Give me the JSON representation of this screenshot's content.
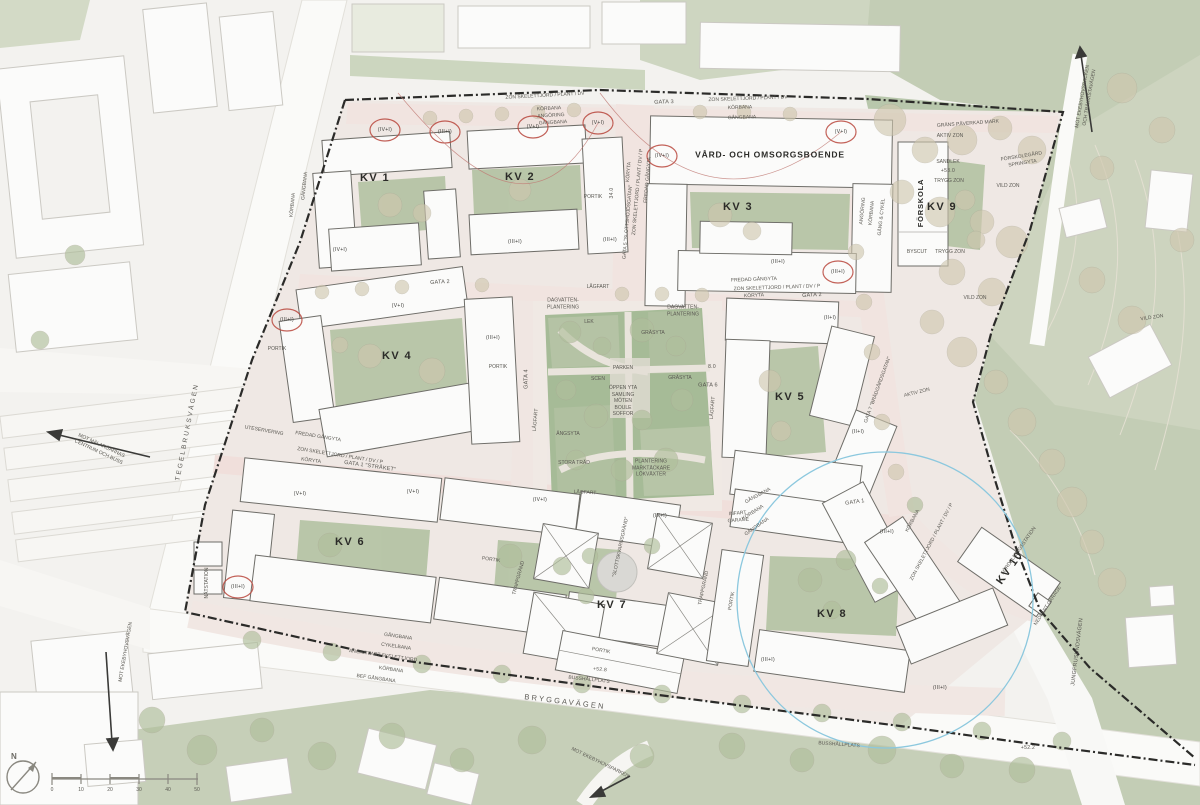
{
  "blocks": {
    "kv1": "KV 1",
    "kv2": "KV 2",
    "kv3": "KV 3",
    "kv4": "KV 4",
    "kv5": "KV 5",
    "kv6": "KV 6",
    "kv7": "KV 7",
    "kv8": "KV 8",
    "kv9": "KV 9",
    "kv10": "KV 10"
  },
  "buildings": {
    "care_home": "VÅRD- OCH OMSORGSBOENDE",
    "preschool": "FÖRSKOLA",
    "preschool_yard_house": "BYSCUT",
    "distribution_station": "FÖRDELNINGSSTATION",
    "substation": "NÄTSTATION"
  },
  "streets": {
    "bryggavagen": "BRYGGAVÄGEN",
    "tegelbruksvagen": "TEGELBRUKSVÄGEN",
    "jungfrusundsvagen": "JUNGFRUSUNDSVÄGEN",
    "gata1": "GATA 1 \"STRÅKET\"",
    "gata1_short": "GATA 1",
    "gata2": "GATA 2",
    "gata3": "GATA 3",
    "gata4": "GATA 4",
    "gata5": "GATA 5 \"SLOTTSHÖJDSGATAN\"",
    "gata6": "GATA 6",
    "gata7": "GATA 7 \"BRÄDGÅRDSGATAN\"",
    "slottskvarnsgrand": "\"SLOTTSKVARNSGRÄND\""
  },
  "park": {
    "dagvatten": "DAGVATTEN-PLANTERING",
    "lek": "LEK",
    "grasyta": "GRÄSYTA",
    "parken": "PARKEN",
    "scen": "SCEN",
    "open_block": "ÖPPEN YTA SAMLING MÖTEN BOULE SOFFOR",
    "angsyta": "ÄNGSYTA",
    "stora_trad": "STORA TRÄD",
    "plantering_block": "PLANTERING MARKTÄCKARE LÖKVÄXTER"
  },
  "zones": {
    "grans": "GRÄNS PÅVERKAD MARK",
    "aktiv": "AKTIV ZON",
    "vild": "VILD ZON",
    "trygg": "TRYGG ZON",
    "sandlek": "SANDLEK",
    "forskolegard": "FÖRSKOLEGÅRD SPRINGYTA"
  },
  "traffic": {
    "korbana": "KÖRBANA",
    "gangbana": "GÅNGBANA",
    "cykelbana": "CYKELBANA",
    "angoring": "ANGÖRING",
    "lagfart": "LÅGFART",
    "koryta": "KÖRYTA",
    "portik": "PORTIK",
    "trappgrand": "TRAPPGRÄND",
    "busshallplats": "BUSSHÅLLPLATS",
    "infart_garage": "INFART GARAGE",
    "nedfart_garage": "NEDFART GARAGE",
    "gang_cykel": "GÅNG & CYKEL",
    "bef_gangbana": "BEF GÅNGBANA",
    "ang_utfart": "ANG/UTFART SKELETTJORD",
    "uteservering": "UTESERVERING",
    "fredad": "FREDAD GÅNGYTA",
    "zon_skelett": "ZON SKELETTJORD / PLANT / DV / P",
    "zon_skelett_short": "ZON SKELETTJORD / PLANT / DV"
  },
  "directions": {
    "centrum": "MOT MÄLARÖARNAS CENTRUM OCH BUSS",
    "ekebyhovsparken": "MOT EKEBYHOVSPARKEN",
    "ekebyhovsvagen": "MOT EKEBYHOVSVÄGEN",
    "trakvista": "MOT EKEBYHOVSBACKEN OCH TRÄKVISTAVÄGEN"
  },
  "floors": {
    "v1": "(V+I)",
    "iv1": "(IV+I)",
    "iii1": "(III+I)",
    "ii1": "(II+I)"
  },
  "levels": {
    "l1": "+52.8",
    "l2": "+53.0",
    "l3": "+52.2"
  },
  "dims": {
    "d1": "34.0",
    "d2": "8.0"
  },
  "compass": {
    "north": "N"
  },
  "scalebar": {
    "ticks": [
      "0",
      "10",
      "20",
      "30",
      "40",
      "50"
    ]
  }
}
